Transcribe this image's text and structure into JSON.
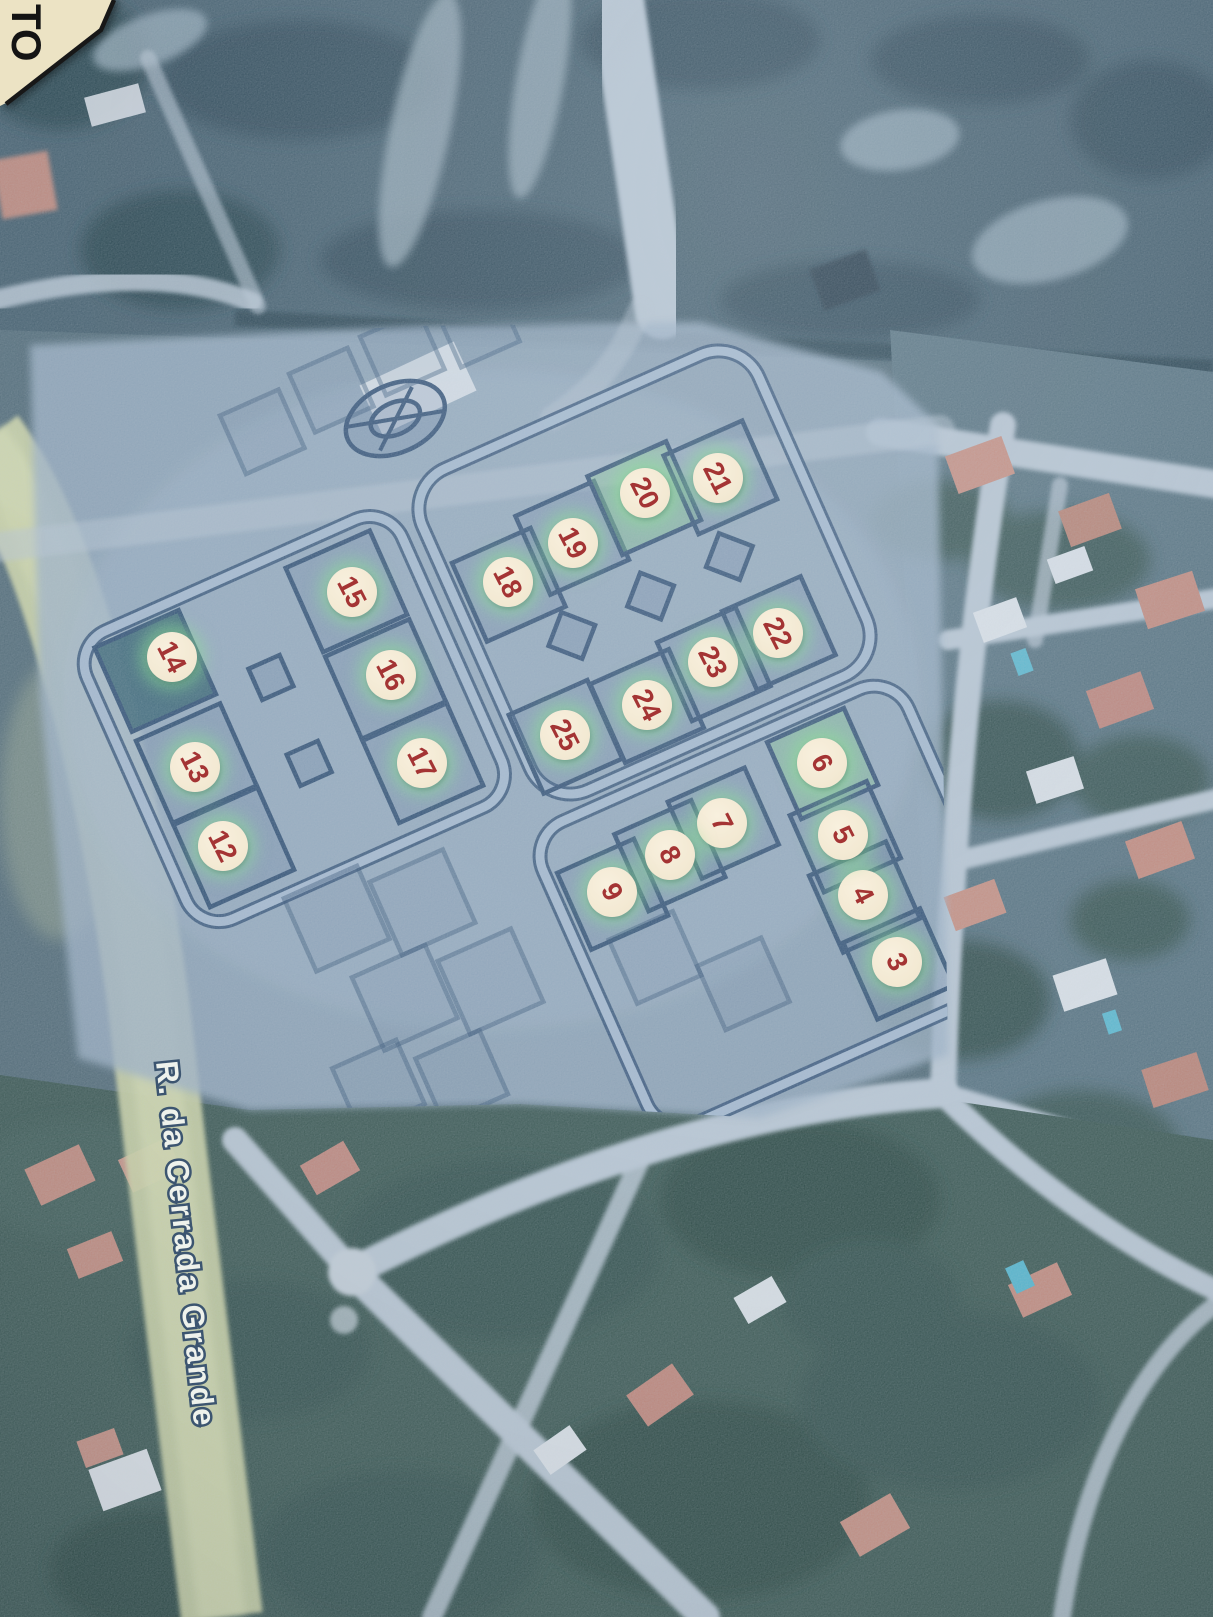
{
  "map": {
    "street_label": "R. da Cerrada Grande",
    "corner_note": "TO",
    "markers": [
      {
        "n": "3",
        "x": 897,
        "y": 962
      },
      {
        "n": "4",
        "x": 863,
        "y": 895
      },
      {
        "n": "5",
        "x": 843,
        "y": 835
      },
      {
        "n": "6",
        "x": 822,
        "y": 763
      },
      {
        "n": "7",
        "x": 722,
        "y": 823
      },
      {
        "n": "8",
        "x": 670,
        "y": 855
      },
      {
        "n": "9",
        "x": 612,
        "y": 892
      },
      {
        "n": "12",
        "x": 223,
        "y": 846
      },
      {
        "n": "13",
        "x": 195,
        "y": 767
      },
      {
        "n": "14",
        "x": 172,
        "y": 657
      },
      {
        "n": "15",
        "x": 352,
        "y": 592
      },
      {
        "n": "16",
        "x": 391,
        "y": 675
      },
      {
        "n": "17",
        "x": 422,
        "y": 763
      },
      {
        "n": "18",
        "x": 508,
        "y": 582
      },
      {
        "n": "19",
        "x": 573,
        "y": 543
      },
      {
        "n": "20",
        "x": 645,
        "y": 493
      },
      {
        "n": "21",
        "x": 718,
        "y": 478
      },
      {
        "n": "22",
        "x": 778,
        "y": 633
      },
      {
        "n": "23",
        "x": 713,
        "y": 662
      },
      {
        "n": "24",
        "x": 647,
        "y": 705
      },
      {
        "n": "25",
        "x": 565,
        "y": 735
      }
    ],
    "colors": {
      "marker_fill": "#f2e8d1",
      "marker_fill_hi": "#f8f0de",
      "marker_num": "#a43434",
      "marker_glow": "rgba(140,225,150,0.55)",
      "plan_line": "#2e4e72",
      "street_light": "#abc0d5",
      "road_light": "#bac8d4",
      "road_yellow": "#d0d7a5",
      "label_fill": "#eef2ec",
      "label_stroke": "#3c5570",
      "paper_corner": "#ece3c4"
    }
  }
}
